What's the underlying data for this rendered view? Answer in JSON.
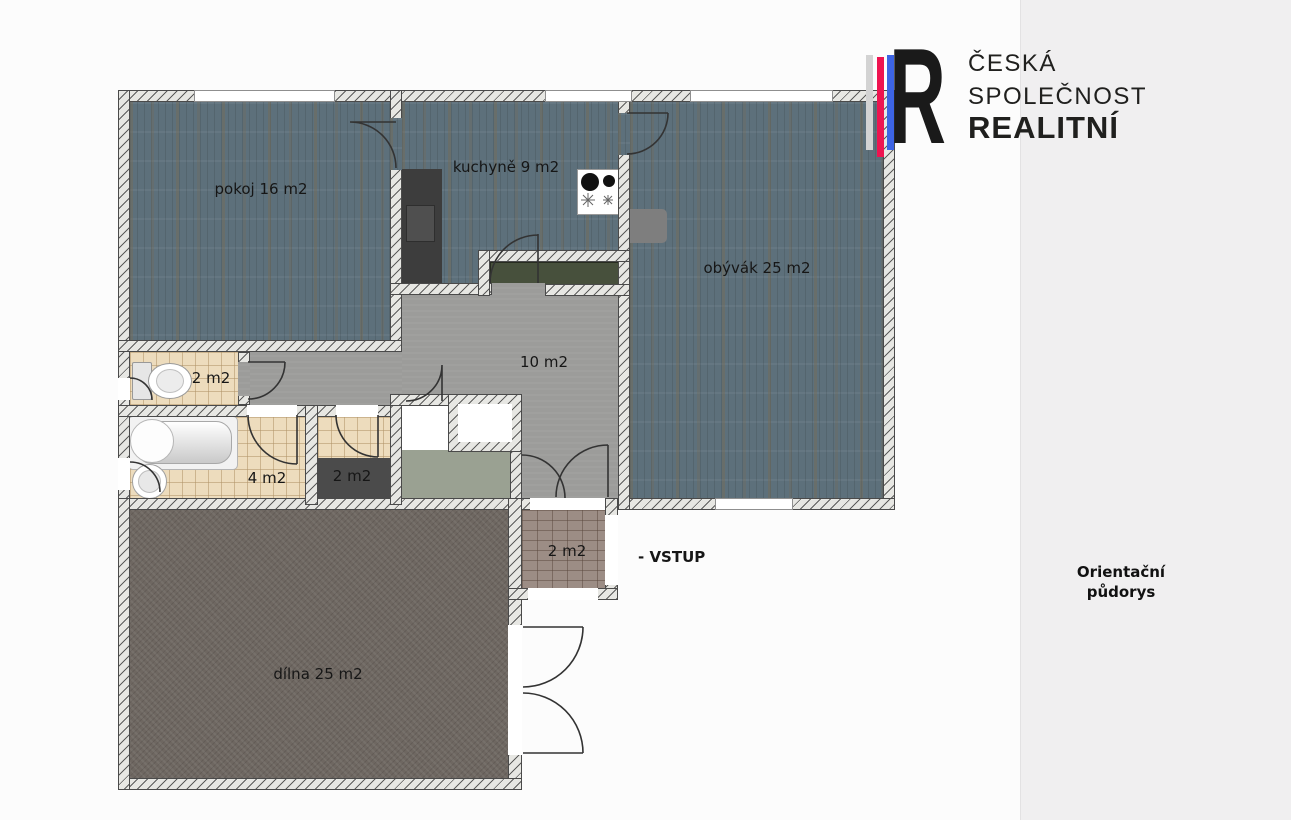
{
  "page": {
    "background": "#fcfcfc",
    "sidebar_background": "#f0eff0"
  },
  "brand": {
    "name_line1": "ČESKÁ",
    "name_line2": "SPOLEČNOST",
    "name_line3": "REALITNÍ",
    "logo_letter": "R",
    "stripe_colors": {
      "gray": "#d3d3d3",
      "red": "#ee1450",
      "blue": "#3d64e4"
    },
    "text_color": "#20201e"
  },
  "sidebar": {
    "caption_line1": "Orientační",
    "caption_line2": "půdorys"
  },
  "floor_plan": {
    "entrance_label": "- VSTUP",
    "rooms": [
      {
        "id": "pokoj",
        "label": "pokoj 16 m2",
        "floor": "wood"
      },
      {
        "id": "kuchyne",
        "label": "kuchyně 9 m2",
        "floor": "wood"
      },
      {
        "id": "obyvak",
        "label": "obývák 25 m2",
        "floor": "wood"
      },
      {
        "id": "chodba",
        "label": "10 m2",
        "floor": "gray"
      },
      {
        "id": "wc",
        "label": "2 m2",
        "floor": "tile"
      },
      {
        "id": "koupelna",
        "label": "4 m2",
        "floor": "tile"
      },
      {
        "id": "komora",
        "label": "2 m2",
        "floor": "tile"
      },
      {
        "id": "zadveri",
        "label": "2 m2",
        "floor": "brick"
      },
      {
        "id": "dilna",
        "label": "dílna 25 m2",
        "floor": "concrete"
      }
    ],
    "colors": {
      "wood_floor": "#5d707b",
      "hall_floor": "#9c9c9a",
      "tile_floor": "#eddcbd",
      "workshop_floor": "#6e6761",
      "brick_floor": "#9c8d85",
      "wall_fill": "#e7e7e3",
      "counter_green": "#47503c"
    }
  }
}
